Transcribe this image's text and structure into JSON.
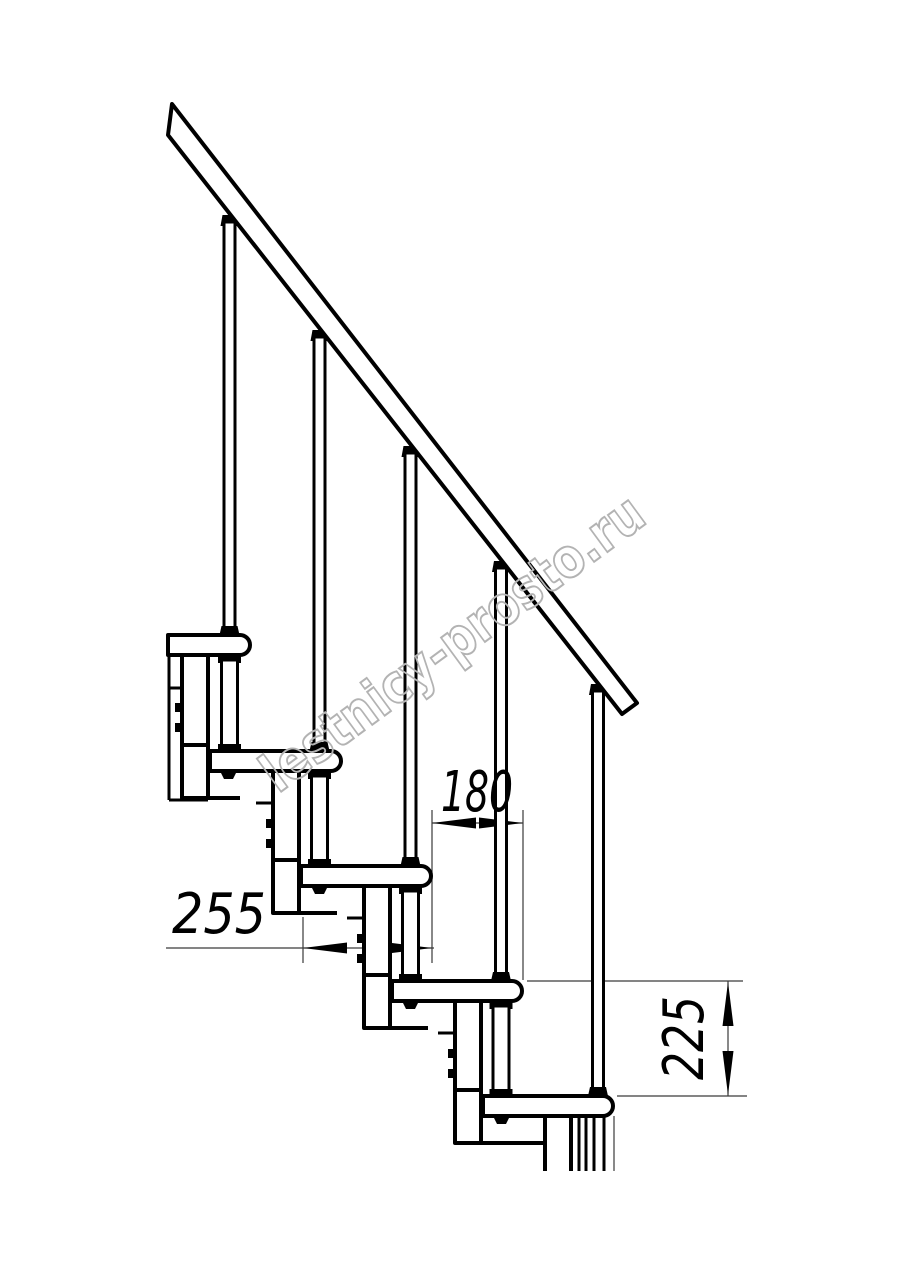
{
  "drawing": {
    "dimension_labels": {
      "step_run": "180",
      "tread_depth": "255",
      "step_rise": "225"
    },
    "watermark": "lestnicy-prosto.ru"
  }
}
